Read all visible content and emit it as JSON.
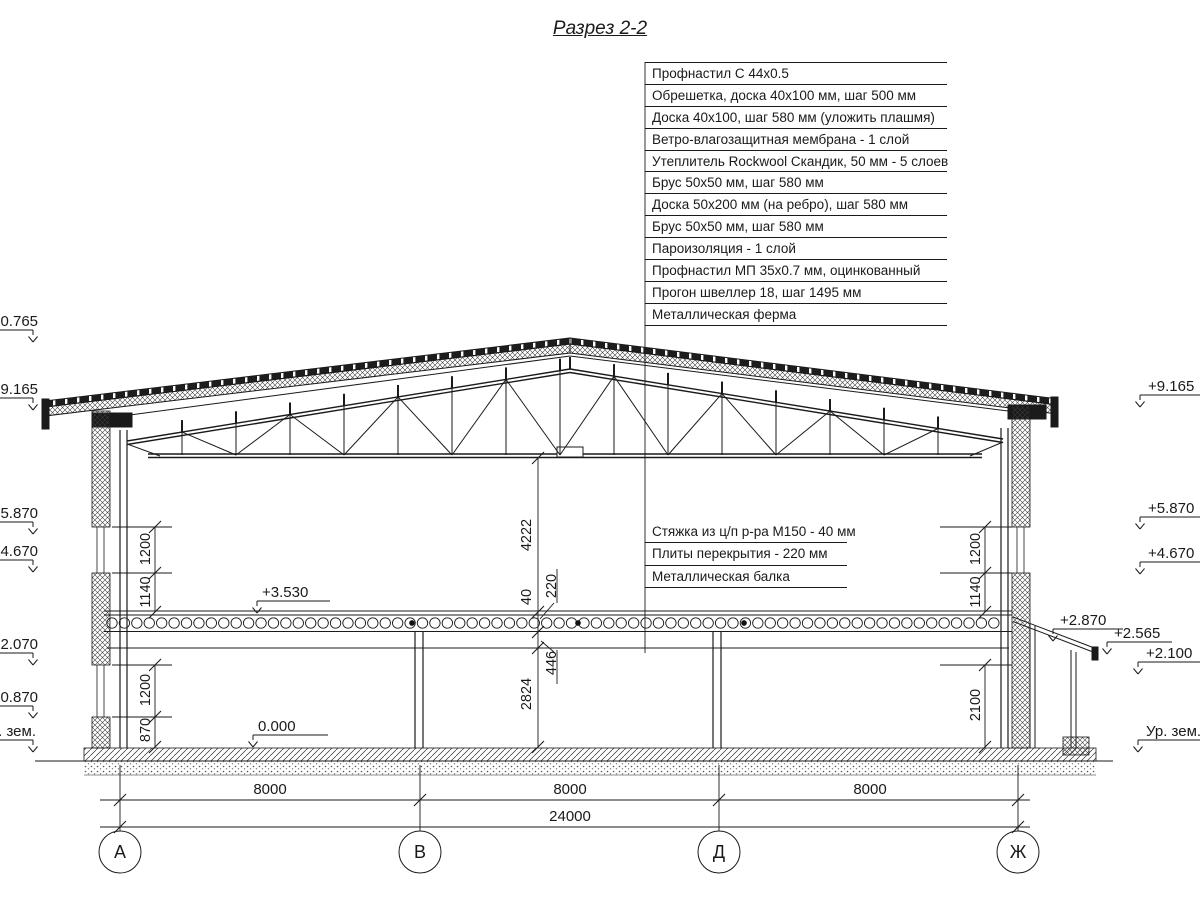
{
  "title": "Разрез 2-2",
  "roof_callouts": [
    "Профнастил С 44х0.5",
    "Обрешетка, доска 40х100 мм, шаг 500 мм",
    "Доска 40х100, шаг 580 мм (уложить плашмя)",
    "Ветро-влагозащитная мембрана - 1 слой",
    "Утеплитель Rockwool Скандик, 50 мм - 5 слоев",
    "Брус 50х50 мм, шаг 580 мм",
    "Доска 50х200 мм (на ребро), шаг 580 мм",
    "Брус 50х50 мм, шаг 580 мм",
    "Пароизоляция - 1 слой",
    "Профнастил МП 35х0.7 мм, оцинкованный",
    "Прогон швеллер 18, шаг 1495 мм",
    "Металлическая ферма"
  ],
  "floor_callouts": [
    "Стяжка из ц/п р-ра М150 - 40 мм",
    "Плиты перекрытия - 220 мм",
    "Металлическая балка"
  ],
  "elevations_left": [
    "+10.765",
    "+9.165",
    "+5.870",
    "+4.670",
    "+2.070",
    "+0.870",
    "Ур. зем."
  ],
  "elevations_right": [
    "+9.165",
    "+5.870",
    "+4.670",
    "+2.870",
    "+2.565",
    "+2.100",
    "Ур. зем."
  ],
  "level_marks": {
    "slab_top": "+3.530",
    "ground_floor": "0.000"
  },
  "center_dims": {
    "hall_height": "4222",
    "screed": "40",
    "slab": "220",
    "beam": "446",
    "floor_height": "2824"
  },
  "left_wall_dims": {
    "upper": [
      "1200",
      "1140"
    ],
    "lower": [
      "1200",
      "870"
    ]
  },
  "right_wall_dims": {
    "upper": [
      "1200",
      "1140"
    ],
    "lower": [
      "2100"
    ]
  },
  "bottom_dims": {
    "spans": [
      "8000",
      "8000",
      "8000"
    ],
    "total": "24000"
  },
  "axes": [
    "А",
    "В",
    "Д",
    "Ж"
  ]
}
